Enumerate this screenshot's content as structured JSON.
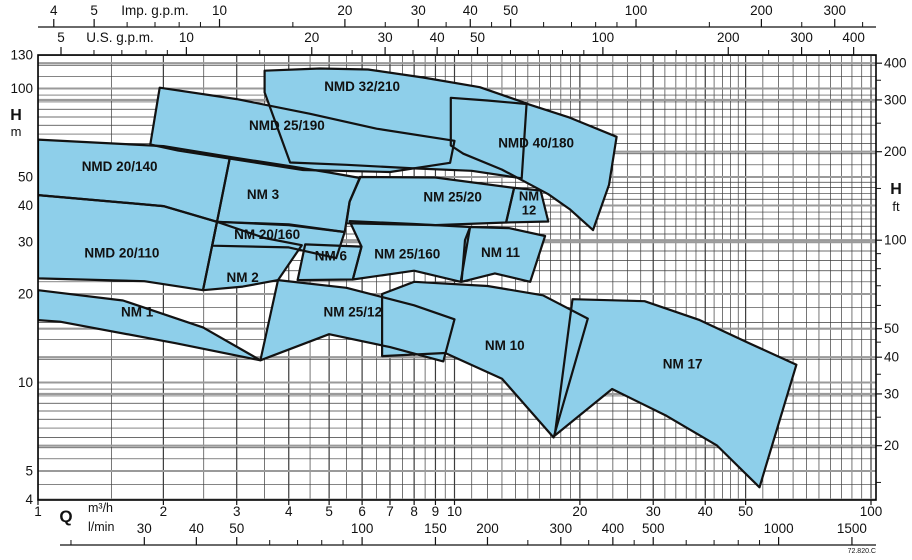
{
  "figure_code": "72.820.C",
  "colors": {
    "region_fill": "#8ECFEA",
    "region_stroke": "#121212",
    "grid_minor": "#3c3c3c",
    "grid_major_gray": "#9a9a9a",
    "frame": "#000000",
    "text": "#111111"
  },
  "chart_data": {
    "type": "area",
    "title": "",
    "x_axis": {
      "label": "Q",
      "scale": "log",
      "range_m3h": [
        1,
        102
      ],
      "m3h_units": "m³/h",
      "lmin_units": "l/min",
      "m3h_labeled": [
        1,
        2,
        3,
        4,
        5,
        6,
        7,
        8,
        9,
        10,
        20,
        30,
        40,
        50,
        100
      ],
      "m3h_minor": [
        1.5,
        2.5,
        3.5,
        4.5,
        5.5,
        6.5,
        7.5,
        8.5,
        9.5,
        11,
        12,
        13,
        14,
        15,
        16,
        17,
        18,
        19,
        22,
        24,
        26,
        28,
        32,
        34,
        36,
        38,
        42,
        44,
        46,
        48,
        55,
        60,
        65,
        70,
        75,
        80,
        85,
        90,
        95
      ],
      "lmin_labeled": [
        30,
        40,
        50,
        100,
        150,
        200,
        300,
        400,
        500,
        1000,
        1500
      ],
      "lmin_minor": [
        20,
        60,
        70,
        80,
        90,
        250,
        350,
        450,
        600,
        700,
        800,
        900
      ],
      "imp_gpm": {
        "label": "Imp. g.p.m.",
        "labeled": [
          4,
          5,
          10,
          20,
          30,
          40,
          50,
          100,
          200,
          300
        ],
        "minor": [
          6,
          7,
          8,
          9,
          15,
          25,
          35,
          45,
          60,
          70,
          80,
          90,
          150,
          250,
          350
        ],
        "per_m3h": 3.666
      },
      "us_gpm": {
        "label": "U.S. g.p.m.",
        "labeled": [
          5,
          10,
          20,
          30,
          40,
          50,
          100,
          200,
          300,
          400
        ],
        "minor": [
          6,
          7,
          8,
          9,
          15,
          25,
          35,
          45,
          60,
          70,
          80,
          90,
          150,
          250,
          350
        ],
        "per_m3h": 4.403
      }
    },
    "y_axis": {
      "label": "H",
      "scale": "log",
      "range_m": [
        4,
        130
      ],
      "m_units": "m",
      "ft_units": "ft",
      "m_labeled": [
        130,
        100,
        50,
        40,
        30,
        20,
        10,
        5,
        4
      ],
      "m_minor": [
        4.5,
        5.5,
        6,
        6.5,
        7,
        7.5,
        8,
        8.5,
        9,
        9.5,
        12,
        14,
        16,
        18,
        22,
        24,
        26,
        28,
        32,
        34,
        36,
        38,
        42,
        44,
        46,
        48,
        55,
        60,
        65,
        70,
        75,
        80,
        85,
        90,
        95,
        110,
        120
      ],
      "ft_labeled": [
        400,
        300,
        200,
        100,
        50,
        40,
        30,
        20
      ],
      "ft_minor": [
        15,
        25,
        35,
        45,
        60,
        70,
        80,
        90,
        150,
        250,
        350
      ],
      "ft_per_m": 3.2808
    },
    "regions": [
      {
        "name": "NMD 20/140",
        "label_at": [
          1.57,
          54
        ],
        "points": [
          [
            1,
            67
          ],
          [
            2,
            63.7
          ],
          [
            2.89,
            58.5
          ],
          [
            2.69,
            35.2
          ],
          [
            2,
            39.8
          ],
          [
            1,
            43.4
          ]
        ]
      },
      {
        "name": "NMD 20/110",
        "label_at": [
          1.59,
          27.5
        ],
        "points": [
          [
            1,
            43.4
          ],
          [
            2,
            39.8
          ],
          [
            2.69,
            35.2
          ],
          [
            2.49,
            20.6
          ],
          [
            1.8,
            22.1
          ],
          [
            1,
            22.6
          ]
        ]
      },
      {
        "name": "NMD 25/190",
        "label_at": [
          3.96,
          74.5
        ],
        "points": [
          [
            1.96,
            100.6
          ],
          [
            3,
            92
          ],
          [
            4.5,
            82
          ],
          [
            6.5,
            73
          ],
          [
            10,
            66.4
          ],
          [
            9.76,
            55.9
          ],
          [
            7,
            52
          ],
          [
            4.33,
            52.8
          ],
          [
            2.17,
            61.5
          ],
          [
            1.86,
            64.5
          ]
        ]
      },
      {
        "name": "NMD 32/210",
        "label_at": [
          6.0,
          101
        ],
        "points": [
          [
            3.5,
            97
          ],
          [
            3.5,
            115
          ],
          [
            4.75,
            117
          ],
          [
            6.2,
            116
          ],
          [
            8.4,
            109
          ],
          [
            11.5,
            101
          ],
          [
            14.9,
            89
          ],
          [
            14.5,
            49.5
          ],
          [
            11,
            52.5
          ],
          [
            8,
            53.5
          ],
          [
            5.5,
            55
          ],
          [
            4.03,
            56
          ]
        ]
      },
      {
        "name": "NMD 40/180",
        "label_at": [
          15.7,
          65
        ],
        "points": [
          [
            9.8,
            93
          ],
          [
            12,
            91
          ],
          [
            15,
            88.5
          ],
          [
            18.9,
            79.6
          ],
          [
            24.5,
            68.5
          ],
          [
            23.5,
            47
          ],
          [
            21.5,
            33
          ],
          [
            18.9,
            38.9
          ],
          [
            16.8,
            43.7
          ],
          [
            13,
            53
          ],
          [
            10.5,
            60
          ],
          [
            9.8,
            64
          ]
        ]
      },
      {
        "name": "NM 3",
        "label_at": [
          3.47,
          43.5
        ],
        "points": [
          [
            2.89,
            58.5
          ],
          [
            4,
            54.5
          ],
          [
            5,
            51.8
          ],
          [
            5.93,
            49.6
          ],
          [
            5.6,
            41.2
          ],
          [
            5.45,
            32.5
          ],
          [
            4,
            34.5
          ],
          [
            2.69,
            35.2
          ]
        ]
      },
      {
        "name": "NM 25/20",
        "label_at": [
          9.9,
          42.6
        ],
        "points": [
          [
            5.93,
            50
          ],
          [
            9,
            49.8
          ],
          [
            13.9,
            45.9
          ],
          [
            13.3,
            35
          ],
          [
            9,
            34.3
          ],
          [
            5.5,
            34.8
          ],
          [
            5.6,
            41.2
          ]
        ]
      },
      {
        "name": "NM 12",
        "label_at": [
          15.1,
          41
        ],
        "label_lines": [
          "NM",
          "12"
        ],
        "points": [
          [
            13.9,
            45.9
          ],
          [
            16.1,
            45
          ],
          [
            16.8,
            35.3
          ],
          [
            13.3,
            35
          ]
        ]
      },
      {
        "name": "NM 20/160",
        "label_at": [
          3.55,
          31.8
        ],
        "points": [
          [
            2.69,
            35.2
          ],
          [
            4,
            34.3
          ],
          [
            5.45,
            32.5
          ],
          [
            5.2,
            26.5
          ],
          [
            4,
            28.8
          ],
          [
            2.62,
            29.2
          ]
        ]
      },
      {
        "name": "NM 6",
        "label_at": [
          5.05,
          26.8
        ],
        "points": [
          [
            4.38,
            29.5
          ],
          [
            5.98,
            29
          ],
          [
            5.7,
            22.4
          ],
          [
            4.2,
            22.3
          ]
        ]
      },
      {
        "name": "NM 25/160",
        "label_at": [
          7.7,
          27.2
        ],
        "points": [
          [
            5.6,
            35.4
          ],
          [
            8,
            34.6
          ],
          [
            10.9,
            33.8
          ],
          [
            10.35,
            22
          ],
          [
            8,
            24
          ],
          [
            5.7,
            22.4
          ],
          [
            5.98,
            29
          ]
        ]
      },
      {
        "name": "NM 11",
        "label_at": [
          12.9,
          27.6
        ],
        "points": [
          [
            10.9,
            33.8
          ],
          [
            13.5,
            33.5
          ],
          [
            16.5,
            31.5
          ],
          [
            15.2,
            22
          ],
          [
            12.5,
            23.5
          ],
          [
            10.4,
            22
          ],
          [
            10.6,
            30.5
          ]
        ]
      },
      {
        "name": "NM 2",
        "label_at": [
          3.1,
          22.7
        ],
        "points": [
          [
            2.69,
            35.2
          ],
          [
            3.5,
            31
          ],
          [
            4.3,
            29.3
          ],
          [
            3.77,
            22.3
          ],
          [
            3.1,
            21.2
          ],
          [
            2.49,
            20.6
          ]
        ]
      },
      {
        "name": "NM 1",
        "label_at": [
          1.73,
          17.3
        ],
        "points": [
          [
            1,
            20.6
          ],
          [
            1.6,
            19
          ],
          [
            2.49,
            15.4
          ],
          [
            3.42,
            11.9
          ],
          [
            2.14,
            13.6
          ],
          [
            1.13,
            16.1
          ],
          [
            1,
            16.3
          ]
        ]
      },
      {
        "name": "NM 25/12",
        "label_at": [
          5.7,
          17.3
        ],
        "points": [
          [
            3.77,
            22.3
          ],
          [
            5.5,
            21
          ],
          [
            8,
            18.3
          ],
          [
            10,
            16.4
          ],
          [
            9.4,
            11.8
          ],
          [
            7,
            13.2
          ],
          [
            5,
            14.6
          ],
          [
            3.42,
            11.9
          ]
        ]
      },
      {
        "name": "NM 10",
        "label_at": [
          13.2,
          13.3
        ],
        "points": [
          [
            6.7,
            20
          ],
          [
            8,
            22
          ],
          [
            12,
            21.3
          ],
          [
            16.3,
            19.8
          ],
          [
            20.9,
            16.5
          ],
          [
            17.3,
            6.5
          ],
          [
            13,
            10.3
          ],
          [
            9.5,
            12.6
          ],
          [
            6.7,
            12.3
          ]
        ]
      },
      {
        "name": "NM 17",
        "label_at": [
          35.3,
          11.5
        ],
        "points": [
          [
            19.2,
            19.2
          ],
          [
            28.6,
            18.9
          ],
          [
            38.8,
            16.3
          ],
          [
            51,
            13.6
          ],
          [
            66.2,
            11.5
          ],
          [
            54,
            4.4
          ],
          [
            42.7,
            6.1
          ],
          [
            32.3,
            7.7
          ],
          [
            23.9,
            9.5
          ],
          [
            17.4,
            6.6
          ]
        ]
      }
    ]
  }
}
